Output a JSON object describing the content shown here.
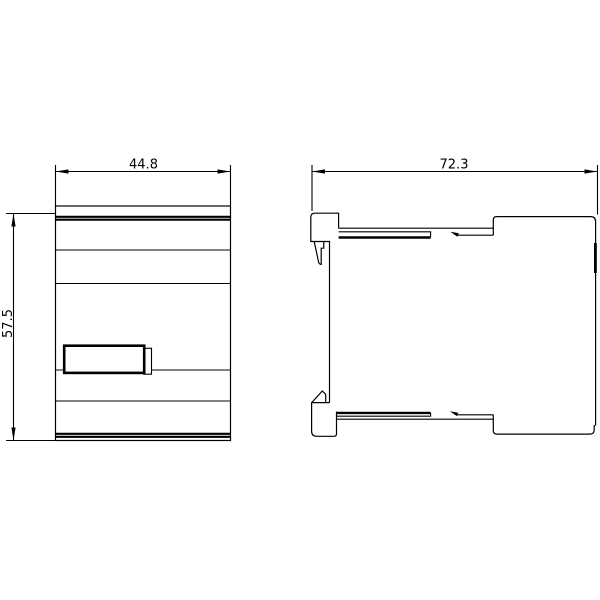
{
  "drawing": {
    "dimensions": {
      "front_width": "44.8",
      "front_height": "57.5",
      "side_depth": "72.3"
    },
    "colors": {
      "line": "#000000",
      "background": "#ffffff"
    }
  }
}
